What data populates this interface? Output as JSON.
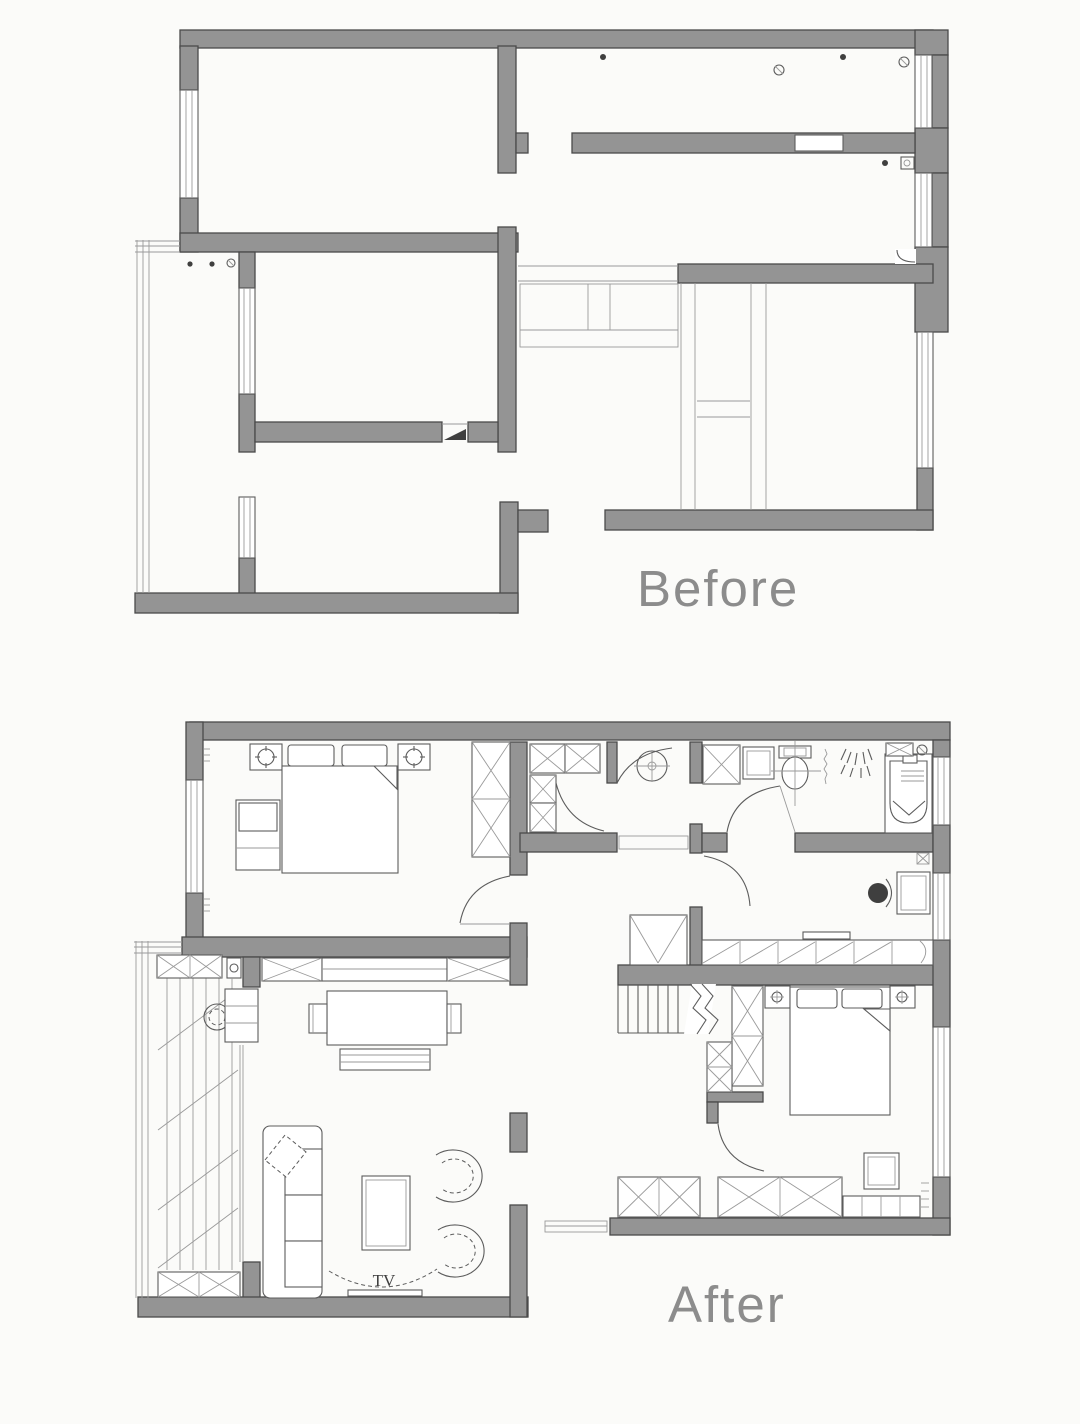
{
  "canvas": {
    "width": 1080,
    "height": 1424,
    "background": "#fbfbf9"
  },
  "colors": {
    "bg": "#fbfbf9",
    "wall_fill": "#949494",
    "wall_stroke": "#4a4a4a",
    "line": "#5c5c5c",
    "thin": "#9a9a9a",
    "ink": "#3f3f3f",
    "label": "#8c8c8c"
  },
  "before_plan": {
    "label": "Before"
  },
  "after_plan": {
    "label": "After",
    "tv_label": "TV"
  }
}
